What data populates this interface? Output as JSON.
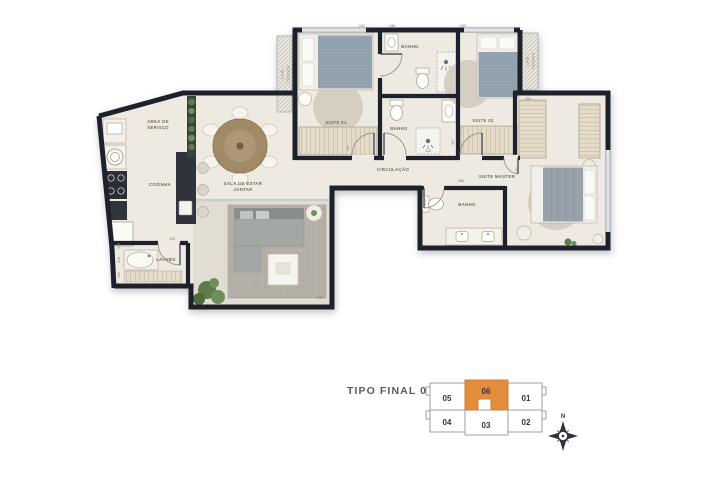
{
  "title": {
    "text": "TIPO FINAL 06"
  },
  "plan": {
    "rooms": {
      "area_servico_1": "ÁREA DE",
      "area_servico_2": "SERVIÇO",
      "cozinha": "COZINHA",
      "sala_1": "SALA DE ESTAR",
      "sala_2": "JANTAR",
      "lavabo": "LAVABO",
      "suite_01": "SUITE 01",
      "banho_suite_01": "BANHO",
      "banho_social": "BANHO",
      "suite_02": "SUITE 02",
      "circulacao": "CIRCULAÇÃO",
      "suite_master": "SUITE MASTER",
      "banho_master": "BANHO",
      "laje_1": "LAJE",
      "laje_2": "TÉCNICA"
    },
    "dimensions": [
      {
        "value": "240"
      },
      {
        "value": "148"
      },
      {
        "value": "245"
      },
      {
        "value": "250"
      },
      {
        "value": "107"
      },
      {
        "value": "107"
      },
      {
        "value": "148"
      },
      {
        "value": "565"
      },
      {
        "value": "240"
      },
      {
        "value": "176"
      },
      {
        "value": "135"
      },
      {
        "value": "146"
      },
      {
        "value": "100"
      },
      {
        "value": "195"
      },
      {
        "value": "240"
      }
    ]
  },
  "key_plan": {
    "units": [
      {
        "id": "05"
      },
      {
        "id": "06"
      },
      {
        "id": "01"
      },
      {
        "id": "04"
      },
      {
        "id": "03"
      },
      {
        "id": "02"
      }
    ],
    "highlighted_unit": "06",
    "compass_north": "N"
  },
  "colors": {
    "wall": "#1C212B",
    "floor": "#EFEAE1",
    "accent_orange": "#E38C3B",
    "rug_gray": "#B5B1A9",
    "keyplan_outline": "#9BA1A7"
  }
}
